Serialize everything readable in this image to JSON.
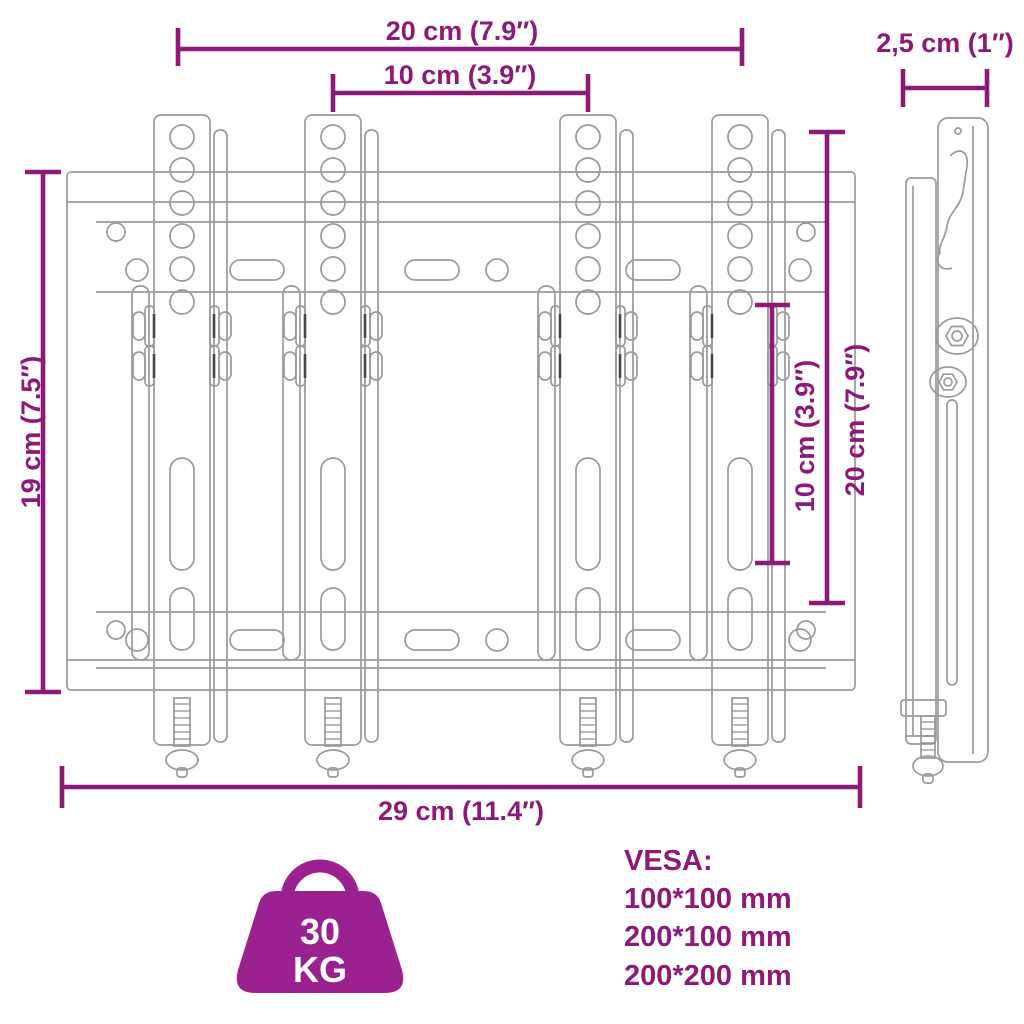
{
  "figure": {
    "type": "product-dimension-diagram",
    "subject": "tv-wall-mount-bracket",
    "dimensions": {
      "top_outer": "20 cm (7.9″)",
      "top_inner": "10 cm (3.9″)",
      "side_depth": "2,5 cm (1″)",
      "left_height": "19 cm (7.5″)",
      "right_inner": "10 cm (3.9″)",
      "right_outer": "20 cm (7.9″)",
      "bottom_width": "29 cm (11.4″)"
    },
    "weight_badge": {
      "value": "30",
      "unit": "KG"
    },
    "vesa": {
      "title": "VESA:",
      "sizes": [
        "100*100 mm",
        "200*100 mm",
        "200*200 mm"
      ]
    },
    "icons": {
      "weight_badge": "kettlebell-weight-icon"
    },
    "colors": {
      "accent": "#8d1a78",
      "badge": "#9c2190",
      "line": "#9a9a9a"
    }
  }
}
